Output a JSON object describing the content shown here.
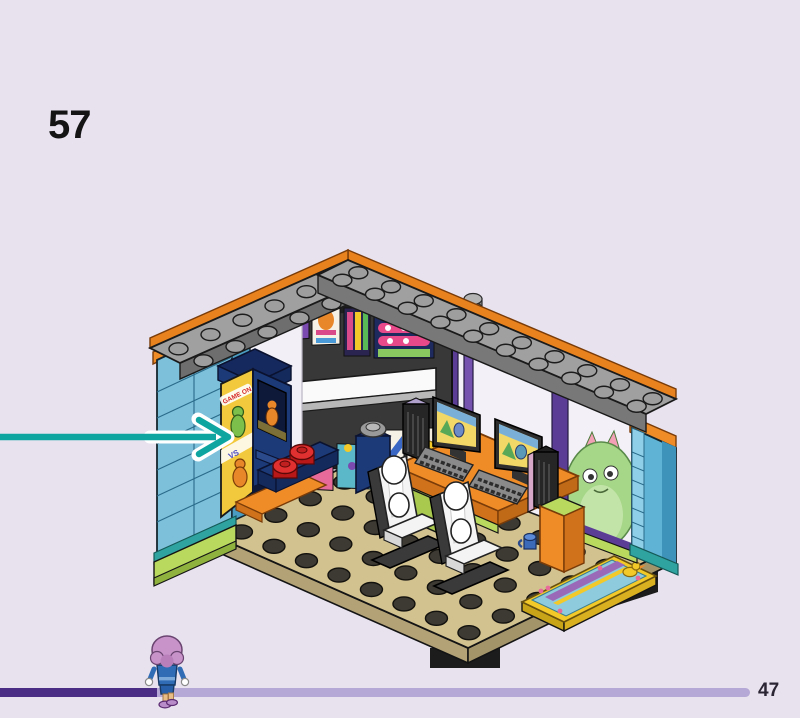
{
  "page": {
    "background_color": "#e8e2ef",
    "step_number": "57",
    "page_number": "47"
  },
  "callout_arrow": {
    "color": "#0ea5a0",
    "direction": "right",
    "points_at": "arcade-cabinet"
  },
  "progress_bar": {
    "fill_color": "#4b2d86",
    "track_color": "#b6a8d6",
    "fraction": 0.21
  },
  "character": {
    "type": "friends-mini-doll",
    "hair_color": "#c793c9",
    "outfit_color": "#2f6cb5",
    "shoe_color": "#9a5ab8"
  },
  "illustration": {
    "name": "lego-gaming-cafe-model",
    "decals": {
      "arcade_marquee_text": "GAME ON",
      "arcade_vs_text": "VS",
      "menu_board_letter": "W"
    },
    "palette": {
      "floor_tan": "#d2c290",
      "floor_side": "#b3a276",
      "stud_dark": "#3d3a33",
      "wall_azure": "#7cc0da",
      "wall_azure_shade": "#4a9cc0",
      "plate_gray": "#a0a0a0",
      "trim_orange": "#ef8c28",
      "frame_purple": "#5c3d96",
      "base_lime": "#b9d95e",
      "accent_teal": "#2fa3a0",
      "cabinet_navy": "#1c3a78",
      "sticker_yellow": "#f2c93c",
      "stool_red": "#d62626",
      "chair_white": "#f4f4f4",
      "poster_wall_dark": "#383838",
      "rug_teal": "#8ecbdc",
      "rug_yellow": "#f2c928",
      "monster_green": "#a6d687"
    }
  }
}
